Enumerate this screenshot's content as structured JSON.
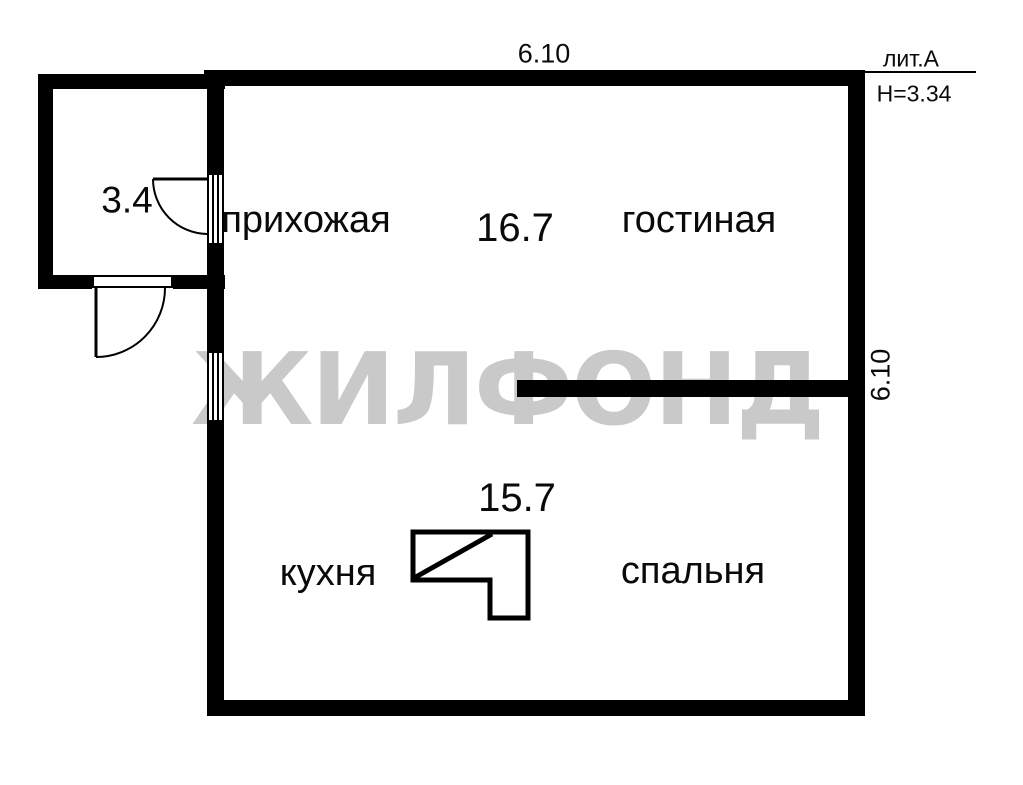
{
  "floor_plan": {
    "watermark": "ЖИЛФОНД",
    "title_block": {
      "litera": "лит.А",
      "ceiling_height": "H=3.34"
    },
    "dimensions": {
      "top_width": "6.10",
      "right_height": "6.10"
    },
    "labels": {
      "hallway": "прихожая",
      "living_room": "гостиная",
      "kitchen": "кухня",
      "bedroom": "спальня"
    },
    "areas": {
      "porch": "3.4",
      "upper_zone": "16.7",
      "lower_zone": "15.7"
    },
    "colors": {
      "wall": "#000000",
      "background": "#ffffff",
      "watermark": "#c9c9c9"
    },
    "symbols": {
      "stove": "stove-symbol",
      "balcony_door": "swing-door",
      "entrance_door": "swing-door",
      "kitchen_window": "window"
    }
  }
}
